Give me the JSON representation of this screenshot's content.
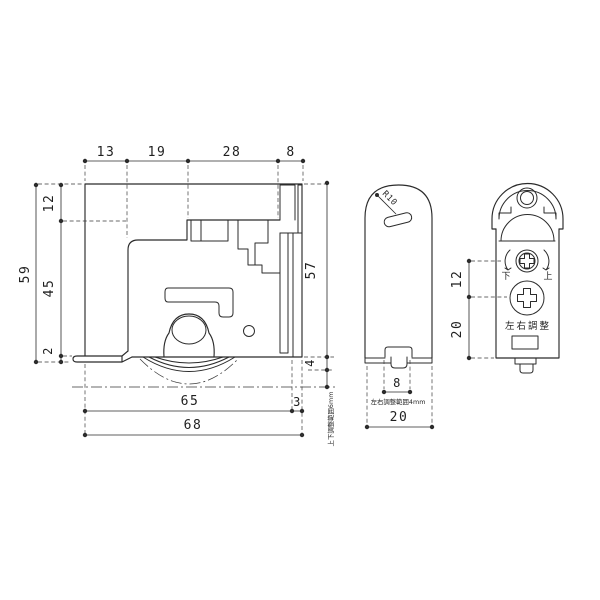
{
  "page": {
    "background": "#ffffff"
  },
  "colors": {
    "line": "#2b2b2b",
    "text": "#1f1f1f"
  },
  "front_view": {
    "dims": {
      "top1": "13",
      "top2": "19",
      "top3": "28",
      "top4": "8",
      "left_outer": "59",
      "left1": "12",
      "left2": "45",
      "left3": "2",
      "right1": "57",
      "right2": "4",
      "bottom1": "65",
      "bottom2": "3",
      "bottom3": "68"
    },
    "note_vertical": "上下調整範囲6mm"
  },
  "side_view": {
    "radius_label": "R10",
    "dim_tab_width": "8",
    "note": "左右調整範囲4mm",
    "dim_width": "20"
  },
  "back_view": {
    "dim_upper": "12",
    "dim_lower": "20",
    "label_down": "下",
    "label_up": "上",
    "label_adjust": "左右調整"
  }
}
